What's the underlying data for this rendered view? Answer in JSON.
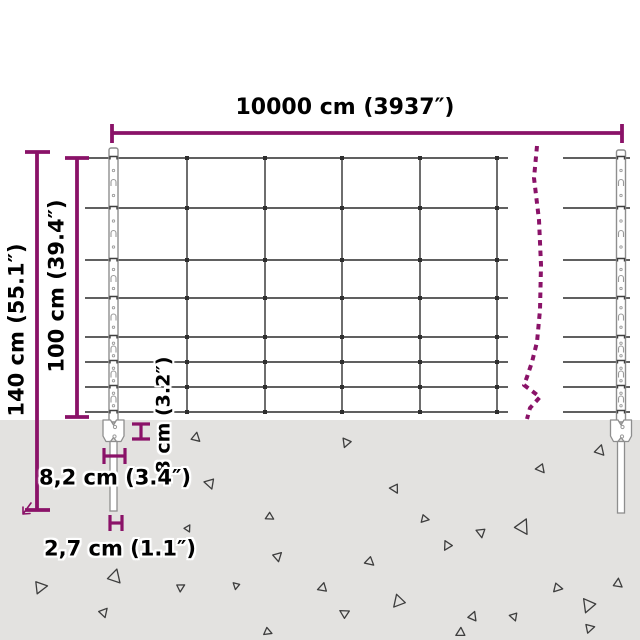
{
  "labels": {
    "width": "10000 cm (3937″)",
    "total_height": "140 cm (55.1″)",
    "mesh_height": "100 cm (39.4″)",
    "anchor_height": "8 cm (3.2″)",
    "anchor_width": "8,2 cm (3.4″)",
    "spike_width": "2,7 cm (1.1″)"
  },
  "colors": {
    "accent": "#8A1268",
    "wire": "#4A4A4A",
    "knot": "#2E2E2E",
    "post_stroke": "#8E8E8E",
    "post_fill": "#FFFFFF",
    "post_detail": "#9A9A9A",
    "clamp": "#3F3F3F",
    "ground": "#E3E2E0",
    "debris": "#3D3D3D",
    "background": "#FFFFFF"
  },
  "geometry": {
    "ground_y": 420,
    "wire_ys": [
      158,
      208,
      260,
      298,
      337,
      362,
      387,
      412
    ],
    "vertical_xs": [
      187,
      265,
      342,
      420,
      497
    ],
    "mesh_left_span": [
      85,
      508
    ],
    "mesh_right_span": [
      563,
      630
    ],
    "posts": [
      {
        "cx": 113.5,
        "top": 148,
        "spike_bottom": 511
      },
      {
        "cx": 621,
        "top": 150,
        "spike_bottom": 513
      }
    ],
    "break_line_points": [
      [
        537,
        146
      ],
      [
        534,
        178
      ],
      [
        539,
        220
      ],
      [
        541,
        265
      ],
      [
        540,
        310
      ],
      [
        537,
        342
      ],
      [
        532,
        362
      ],
      [
        527,
        377
      ],
      [
        524,
        385
      ],
      [
        540,
        397
      ],
      [
        530,
        408
      ],
      [
        527,
        419
      ]
    ],
    "dimension_lines": {
      "top": {
        "line": [
          112,
          133,
          622,
          133
        ],
        "ticks": [
          [
            112,
            124,
            112,
            143
          ],
          [
            622,
            124,
            622,
            143
          ]
        ]
      },
      "h140": {
        "line": [
          37,
          152,
          37,
          510
        ],
        "ticks": [
          [
            25,
            152,
            50,
            152
          ],
          [
            25,
            510,
            50,
            510
          ]
        ]
      },
      "h100": {
        "line": [
          77,
          158,
          77,
          417
        ],
        "ticks": [
          [
            65,
            158,
            89,
            158
          ],
          [
            65,
            417,
            89,
            417
          ]
        ]
      },
      "d8": {
        "line": [
          141,
          424,
          141,
          439
        ],
        "ticks": [
          [
            132,
            424,
            150,
            424
          ],
          [
            132,
            439,
            150,
            439
          ]
        ]
      },
      "d82": {
        "line": [
          104,
          456,
          125,
          456
        ],
        "ticks": [
          [
            104,
            448,
            104,
            464
          ],
          [
            125,
            448,
            125,
            464
          ]
        ]
      },
      "d27": {
        "line": [
          110,
          523,
          122,
          523
        ],
        "ticks": [
          [
            110,
            515,
            110,
            531
          ],
          [
            122,
            515,
            122,
            531
          ]
        ]
      }
    },
    "ground_triangles": [
      [
        196,
        437,
        8,
        10
      ],
      [
        346,
        443,
        8,
        200
      ],
      [
        600,
        450,
        9,
        15
      ],
      [
        541,
        469,
        8,
        140
      ],
      [
        210,
        484,
        9,
        160
      ],
      [
        395,
        489,
        8,
        150
      ],
      [
        270,
        517,
        7,
        120
      ],
      [
        425,
        519,
        7,
        100
      ],
      [
        523,
        526,
        13,
        25
      ],
      [
        481,
        533,
        8,
        170
      ],
      [
        188,
        528,
        6,
        30
      ],
      [
        278,
        556,
        8,
        45
      ],
      [
        447,
        546,
        8,
        210
      ],
      [
        370,
        562,
        8,
        130
      ],
      [
        115,
        576,
        12,
        15
      ],
      [
        41,
        587,
        11,
        80
      ],
      [
        181,
        587,
        7,
        60
      ],
      [
        236,
        586,
        6,
        190
      ],
      [
        322,
        588,
        8,
        250
      ],
      [
        618,
        583,
        8,
        5
      ],
      [
        558,
        588,
        8,
        100
      ],
      [
        588,
        606,
        12,
        200
      ],
      [
        398,
        602,
        11,
        220
      ],
      [
        104,
        612,
        8,
        40
      ],
      [
        344,
        613,
        8,
        300
      ],
      [
        473,
        616,
        8,
        20
      ],
      [
        514,
        617,
        7,
        160
      ],
      [
        590,
        628,
        8,
        75
      ],
      [
        460,
        633,
        8,
        240
      ],
      [
        268,
        632,
        7,
        110
      ]
    ]
  }
}
